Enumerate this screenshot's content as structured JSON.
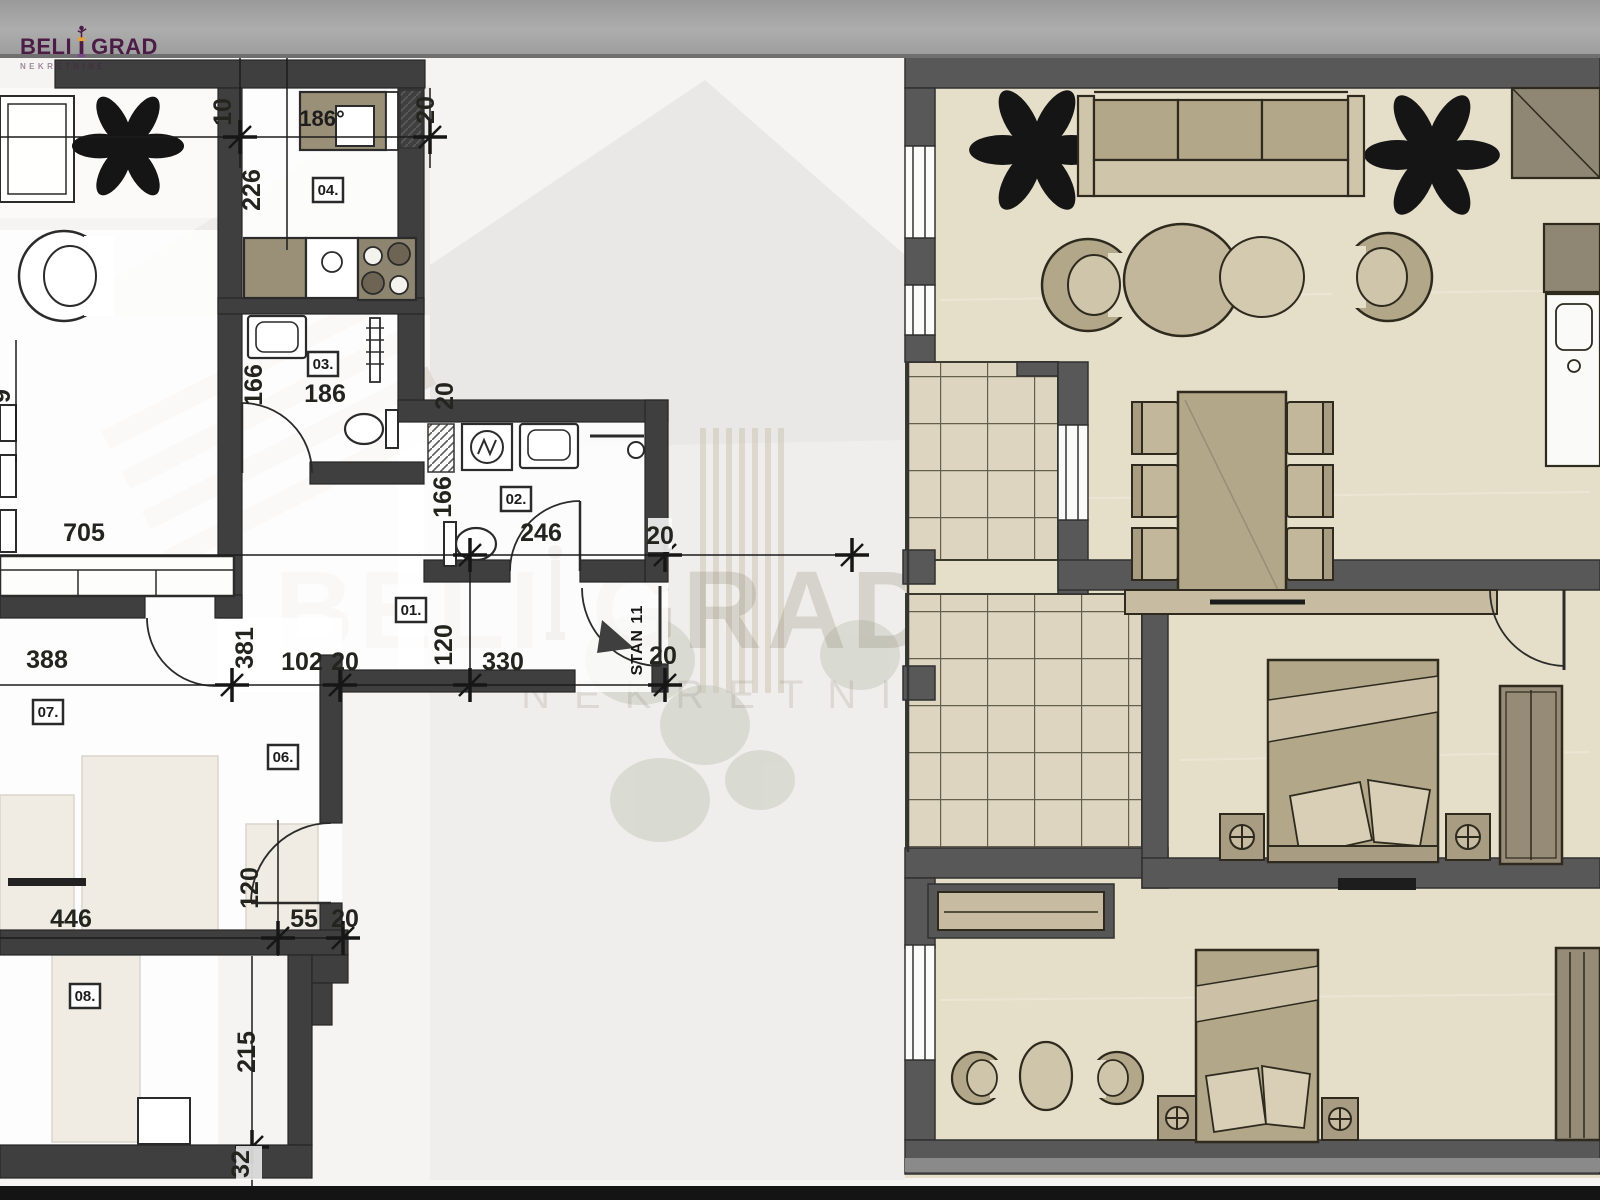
{
  "brand": {
    "word1": "BELI",
    "word2": "GRAD",
    "tagline": "NEKRETNINE",
    "logo_color": "#4b1d46"
  },
  "left_plan": {
    "unit_label": "STAN 11",
    "kitchen_note": "186°",
    "rooms": {
      "r01": "01.",
      "r02": "02.",
      "r03": "03.",
      "r04": "04.",
      "r06": "06.",
      "r07": "07.",
      "r08": "08."
    },
    "dims": {
      "w10": "10",
      "w20a": "20",
      "h226": "226",
      "h166a": "166",
      "w186": "186",
      "w20b": "20",
      "h166b": "166",
      "w246": "246",
      "w20c": "20",
      "h120a": "120",
      "w330": "330",
      "w20d": "20",
      "w705": "705",
      "h9": "9",
      "w388": "388",
      "h381": "381",
      "w102": "102",
      "w20e": "20",
      "w446": "446",
      "h120b": "120",
      "w55": "55",
      "w20f": "20",
      "h215": "215",
      "h32": "32"
    }
  },
  "colors": {
    "top_bar": "#a4a4a4",
    "bottom_bar": "#141414",
    "wall_left": "#3f3f3f",
    "wall_right": "#585858",
    "floor_right": "#e5dec9",
    "terrace": "#ddd5bf",
    "furniture_tan": "#b3a78a",
    "furniture_light": "#cfc5ab",
    "line": "#2b2b2b",
    "dim_text": "#24241f",
    "logo_purple": "#4b1d46",
    "watermark": "#8f8672"
  }
}
